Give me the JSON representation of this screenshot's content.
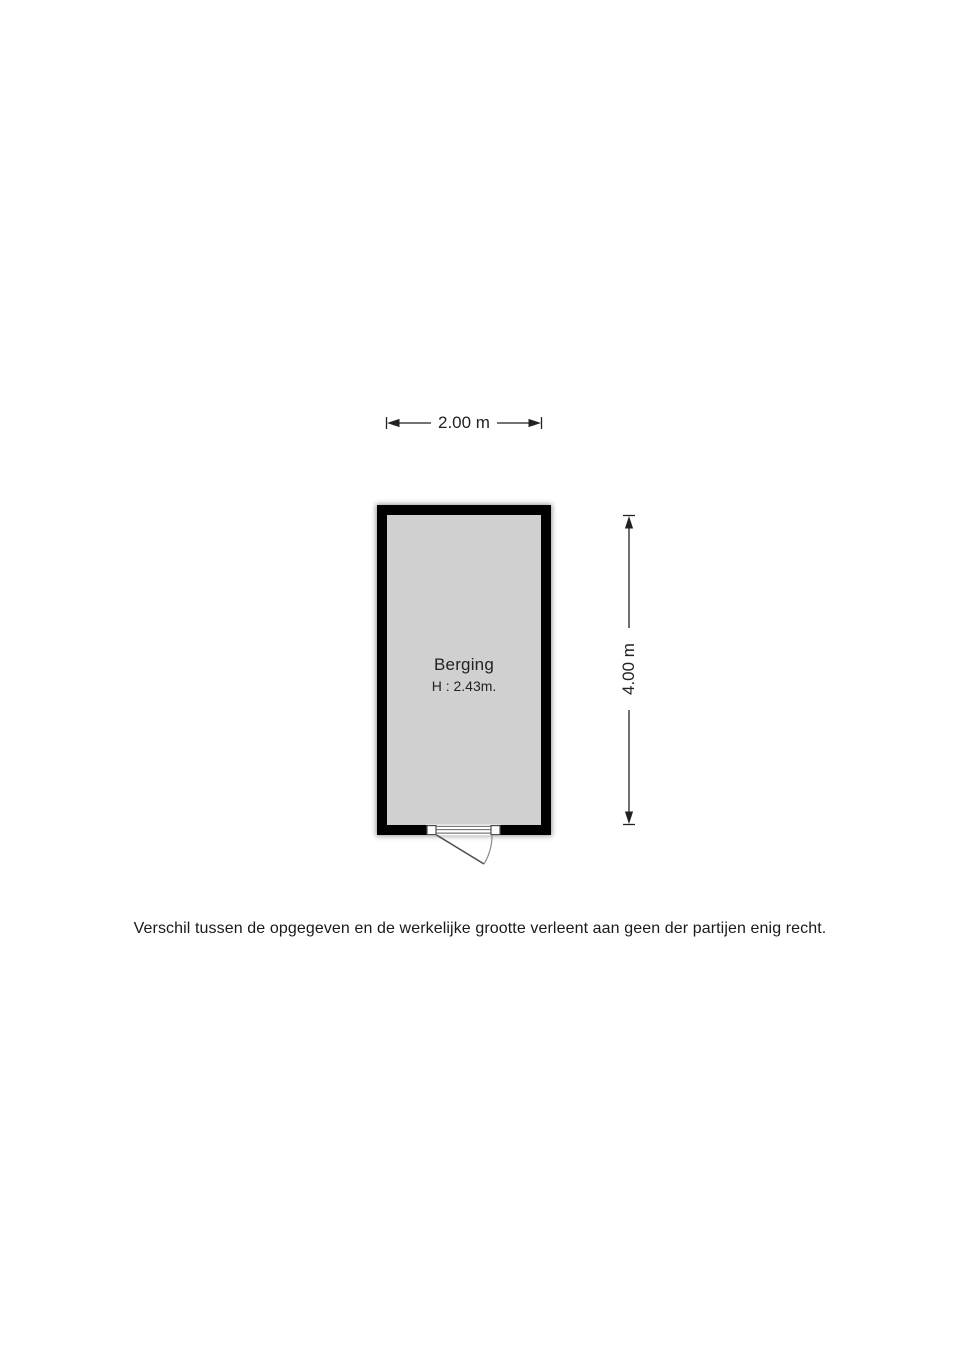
{
  "floorplan": {
    "room": {
      "name": "Berging",
      "ceiling_height": "H : 2.43m."
    },
    "dimensions": {
      "width": "2.00 m",
      "depth": "4.00 m"
    },
    "door": "single-swing-exterior-door",
    "colors": {
      "wall": "#000000",
      "room_fill": "#d0d0d0",
      "dimension_line": "#222222",
      "text": "#1a1a1a",
      "door_line": "#4d4d4d",
      "door_arc": "#8a8a8a",
      "page_bg": "#ffffff"
    },
    "disclaimer": "Verschil tussen de opgegeven en de werkelijke grootte verleent aan geen der partijen enig recht."
  }
}
